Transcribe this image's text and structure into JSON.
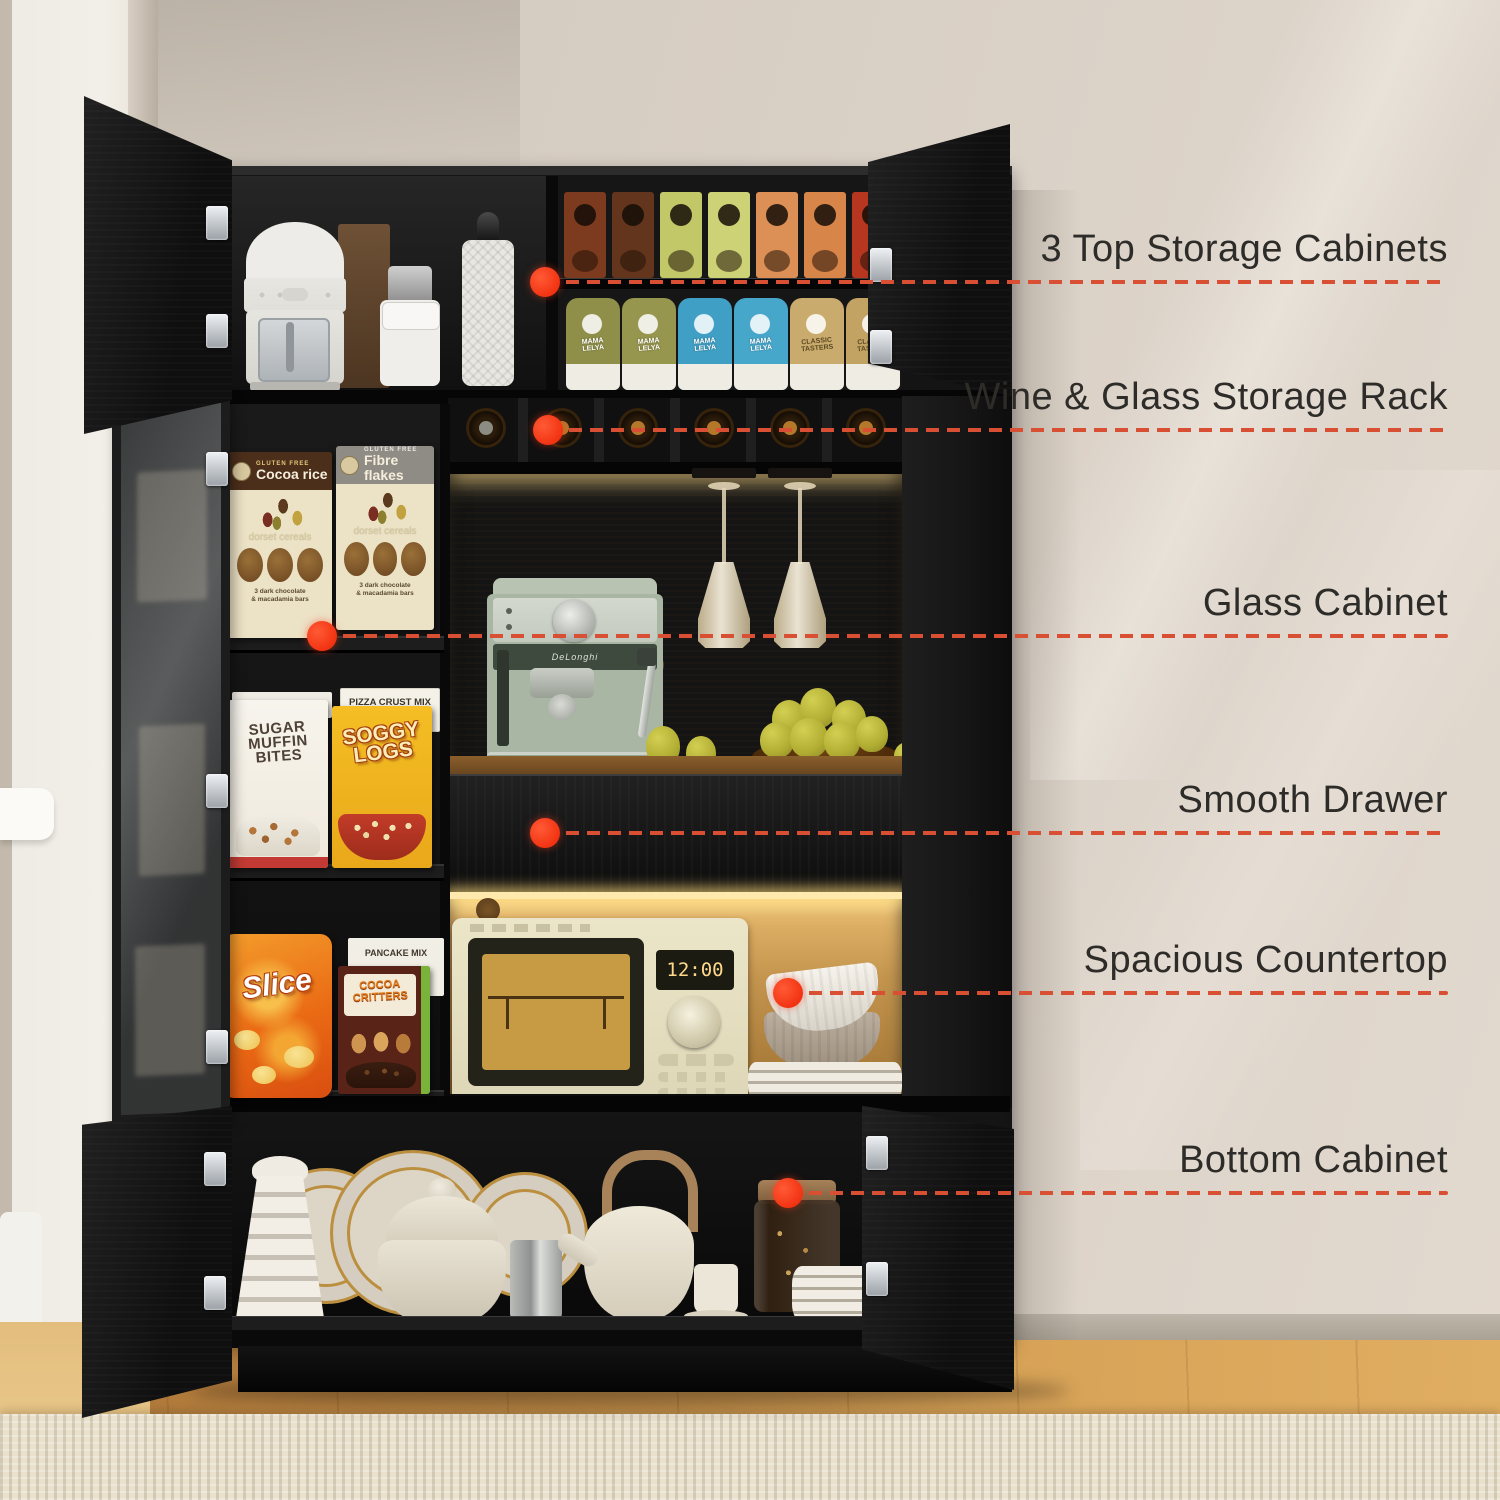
{
  "scene": {
    "description": "Black freestanding kitchen pantry bar cabinet with open doors, LED-lit wood niches and six annotated feature callouts"
  },
  "style": {
    "accent": "#f5391c",
    "dash_line": "#d94f33",
    "label_text": "#2e2c29",
    "cabinet_black": "#141414",
    "wall_beige": "#d8cfc5",
    "wood_niche": "#c2914a",
    "floor_wood": "#d5a055",
    "rug_cream": "#e9e1cd"
  },
  "callouts": [
    {
      "id": "top-storage",
      "label": "3 Top Storage Cabinets"
    },
    {
      "id": "wine-rack",
      "label": "Wine & Glass Storage Rack"
    },
    {
      "id": "glass-cabinet",
      "label": "Glass Cabinet"
    },
    {
      "id": "drawer",
      "label": "Smooth Drawer"
    },
    {
      "id": "countertop",
      "label": "Spacious Countertop"
    },
    {
      "id": "bottom-cabinet",
      "label": "Bottom Cabinet"
    }
  ],
  "products": {
    "cocoa_rice": {
      "badge": "GLUTEN FREE",
      "name": "Cocoa rice",
      "brand": "dorset cereals",
      "subtitle": "3 dark chocolate\n& macadamia bars"
    },
    "fibre_flakes": {
      "badge": "GLUTEN FREE",
      "name": "Fibre flakes",
      "brand": "dorset cereals",
      "subtitle": "3 dark chocolate\n& macadamia bars"
    },
    "pizza_crust": {
      "name": "PIZZA CRUST MIX"
    },
    "sugar_muffin": {
      "name": "SUGAR\nMUFFIN\nBITES"
    },
    "soggy_logs": {
      "name": "SOGGY\nLOGS"
    },
    "pancake_mix": {
      "name": "PANCAKE MIX"
    },
    "slice_chips": {
      "name": "Slice"
    },
    "cocoa_critters": {
      "name": "COCOA\nCRITTERS"
    },
    "snack_bag_mama": {
      "name": "MAMA\nLELYA"
    },
    "snack_bag_classic": {
      "name": "CLASSIC\nTASTERS"
    }
  },
  "appliances": {
    "espresso_machine_brand": "DeLonghi",
    "microwave_display": "12:00"
  }
}
